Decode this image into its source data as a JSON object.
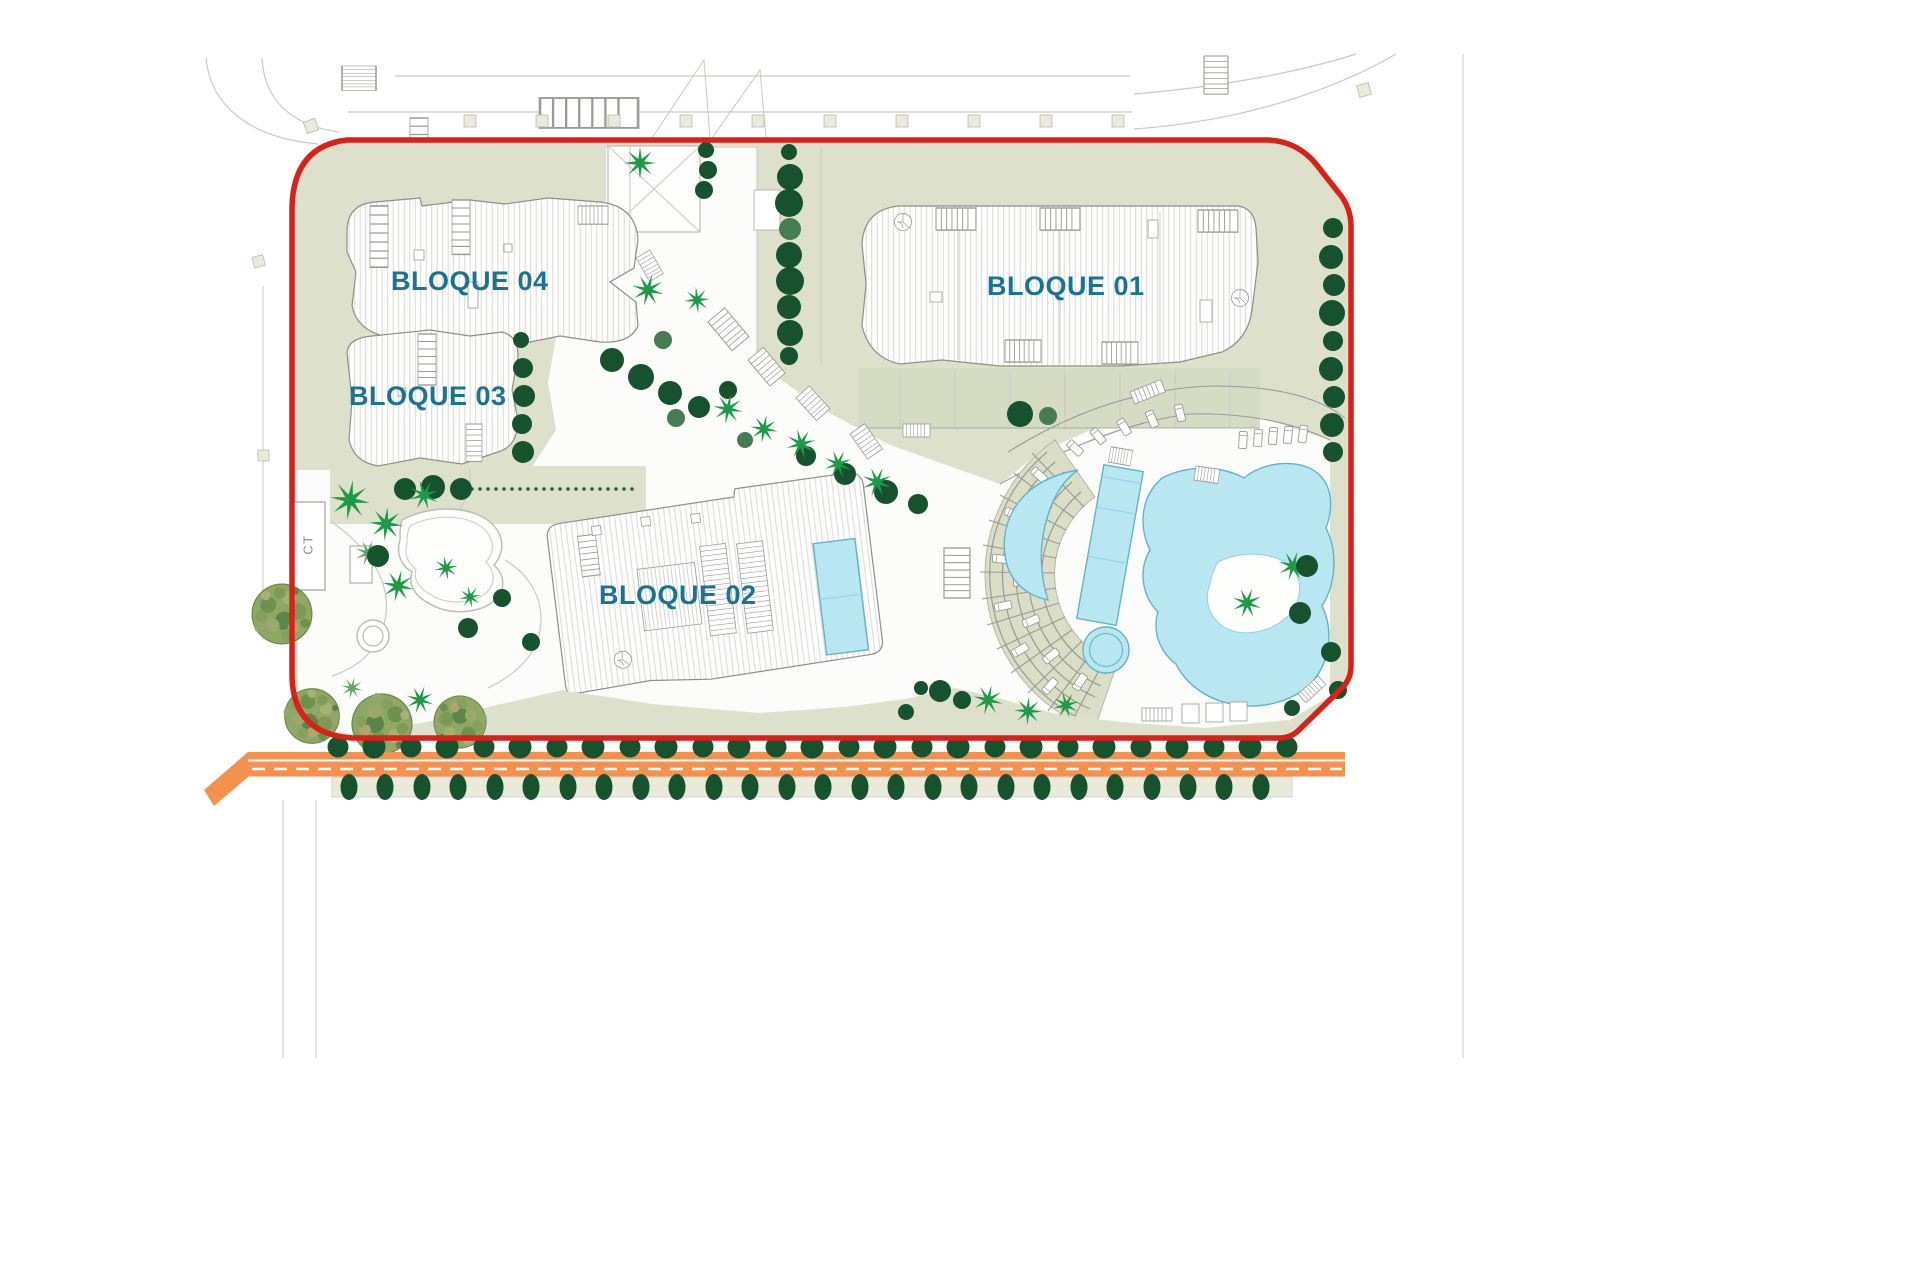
{
  "plan": {
    "labels": {
      "block01": "BLOQUE 01",
      "block02": "BLOQUE 02",
      "block03": "BLOQUE 03",
      "block04": "BLOQUE 04",
      "ct": "CT"
    },
    "colors": {
      "boundary": "#d92019",
      "label": "#1b7392",
      "sage": "#dde1cc",
      "sageDark": "#d6dbc3",
      "tree": "#15522d",
      "treeLight": "#457c54",
      "palm": "#1d9a47",
      "palmLight": "#5fa468",
      "pool": "#b9e7f1",
      "poolEdge": "#62b4cc",
      "road": "#f5914f",
      "line": "#9a9a96",
      "ctText": "#90908c"
    }
  }
}
